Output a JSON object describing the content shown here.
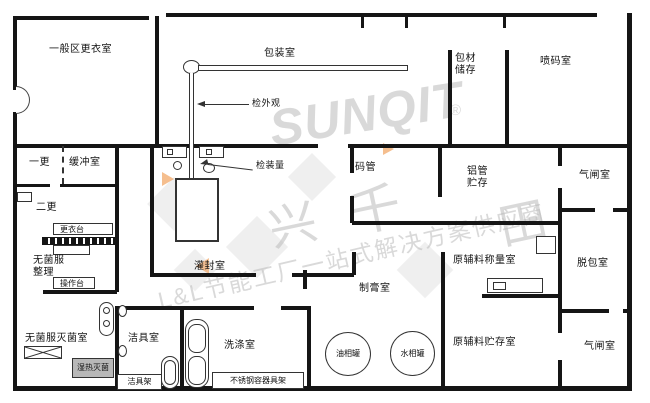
{
  "rooms": {
    "general_changing": {
      "label": "一般区更衣室"
    },
    "packing": {
      "label": "包装室"
    },
    "material_storage": {
      "label": "包材\n储存"
    },
    "spray_code": {
      "label": "喷码室"
    },
    "first_change": {
      "label": "一更"
    },
    "buffer": {
      "label": "缓冲室"
    },
    "second_change": {
      "label": "二更"
    },
    "sterile_sorting": {
      "label": "无菌服\n整理"
    },
    "filling_sealing": {
      "label": "灌封室"
    },
    "tube_stacking": {
      "label": "码管"
    },
    "alu_tube_storage": {
      "label": "铝管\n贮存"
    },
    "airlock_top": {
      "label": "气闸室"
    },
    "weighing": {
      "label": "原辅料称量室"
    },
    "depacking": {
      "label": "脱包室"
    },
    "cream_making": {
      "label": "制膏室"
    },
    "raw_storage": {
      "label": "原辅料贮存室"
    },
    "airlock_bottom": {
      "label": "气闸室"
    },
    "garment_sterilizing": {
      "label": "无菌服灭菌室"
    },
    "cleaning_tools": {
      "label": "洁具室"
    },
    "washing": {
      "label": "洗涤室"
    }
  },
  "equipment": {
    "gown_table": "更衣台",
    "operation_table": "操作台",
    "moist_heat_sterilizer": "湿热灭菌",
    "tool_rack": "洁具架",
    "stainless_rack": "不锈钢容器具架",
    "oil_tank": "油相罐",
    "water_tank": "水相罐"
  },
  "annotations": {
    "check_appearance": "检外观",
    "check_fill_volume": "检装量"
  },
  "watermark": {
    "brand": "SUNQIT",
    "registered": "®",
    "char_1": "兴",
    "char_2": "千",
    "char_3": "田",
    "slogan": "L&L节能工厂一站式解决方案供应商"
  },
  "colors": {
    "wall": "#151515",
    "background": "#ffffff",
    "fixture_line": "#333333",
    "moist_heat_fill": "#b8b8b8",
    "watermark_gray": "#c0c0c0",
    "watermark_orange": "#ef9242"
  }
}
